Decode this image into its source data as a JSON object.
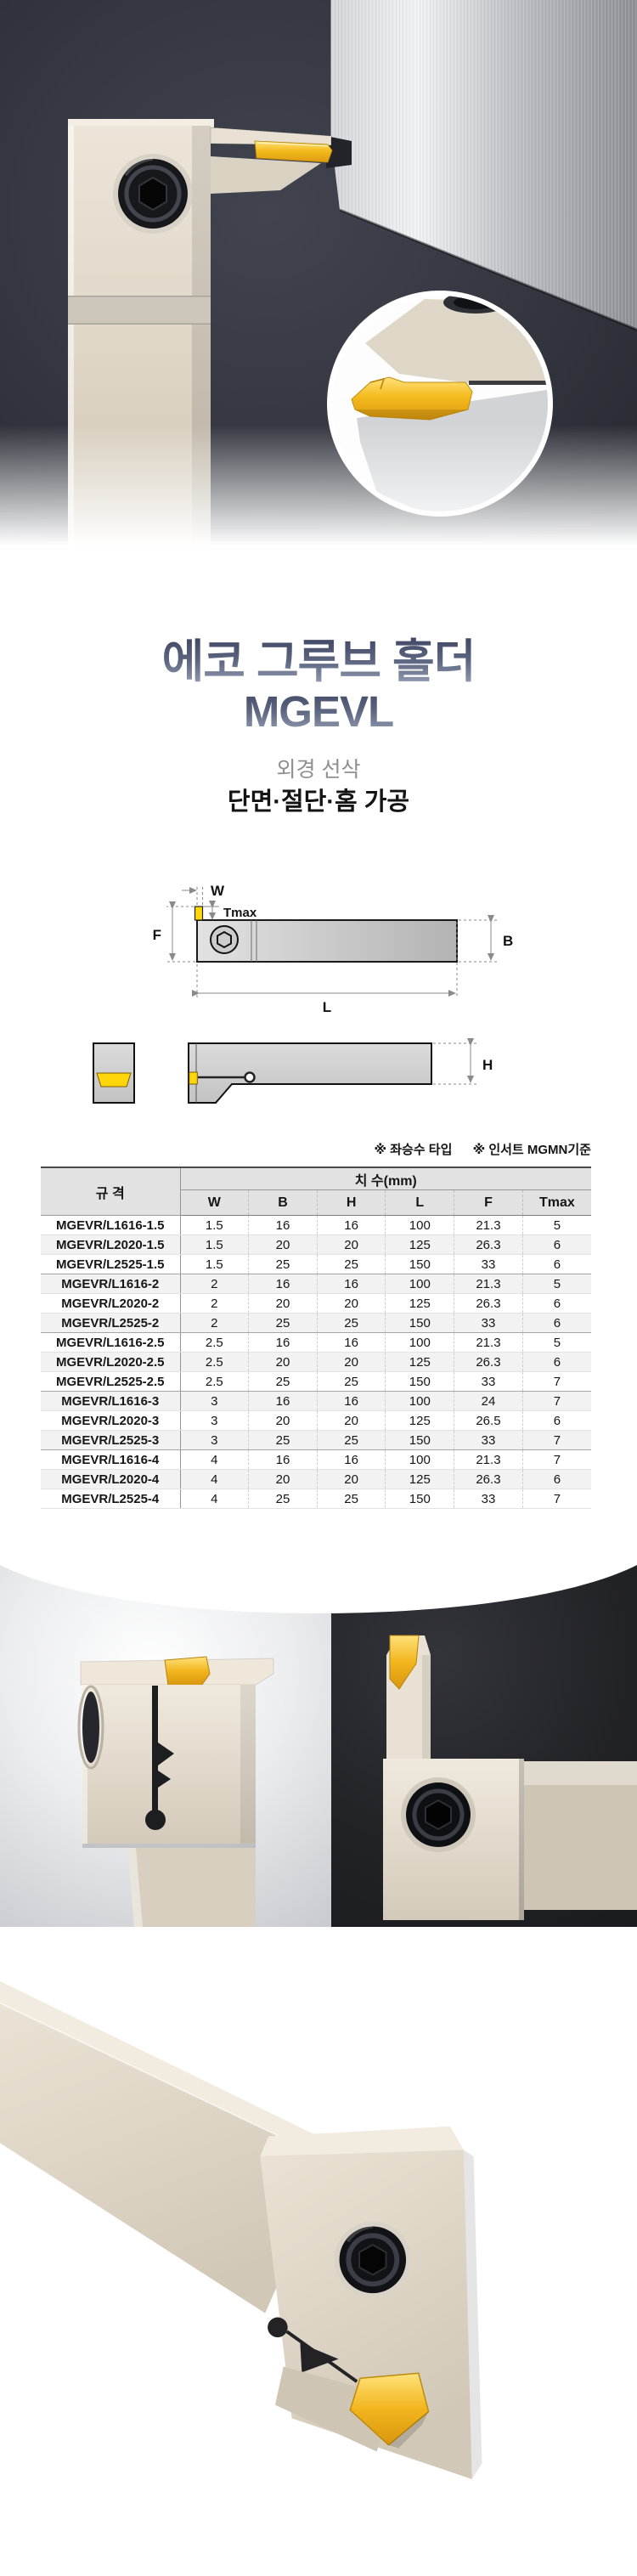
{
  "header": {
    "title_line1": "에코 그루브 홀더",
    "title_line2": "MGEVL",
    "subtitle": "외경 선삭",
    "machining": "단면·절단·홈 가공"
  },
  "notes": {
    "hand_type": "※ 좌승수 타입",
    "insert_standard": "※ 인서트 MGMN기준"
  },
  "diagram": {
    "labels": {
      "w": "W",
      "tmax": "Tmax",
      "f": "F",
      "b": "B",
      "l": "L",
      "h": "H"
    }
  },
  "table": {
    "spec_header": "규 격",
    "dim_header": "치 수(mm)",
    "columns": [
      "W",
      "B",
      "H",
      "L",
      "F",
      "Tmax"
    ],
    "rows": [
      {
        "spec": "MGEVR/L1616-1.5",
        "values": [
          "1.5",
          "16",
          "16",
          "100",
          "21.3",
          "5"
        ]
      },
      {
        "spec": "MGEVR/L2020-1.5",
        "values": [
          "1.5",
          "20",
          "20",
          "125",
          "26.3",
          "6"
        ]
      },
      {
        "spec": "MGEVR/L2525-1.5",
        "values": [
          "1.5",
          "25",
          "25",
          "150",
          "33",
          "6"
        ]
      },
      {
        "spec": "MGEVR/L1616-2",
        "values": [
          "2",
          "16",
          "16",
          "100",
          "21.3",
          "5"
        ]
      },
      {
        "spec": "MGEVR/L2020-2",
        "values": [
          "2",
          "20",
          "20",
          "125",
          "26.3",
          "6"
        ]
      },
      {
        "spec": "MGEVR/L2525-2",
        "values": [
          "2",
          "25",
          "25",
          "150",
          "33",
          "6"
        ]
      },
      {
        "spec": "MGEVR/L1616-2.5",
        "values": [
          "2.5",
          "16",
          "16",
          "100",
          "21.3",
          "5"
        ]
      },
      {
        "spec": "MGEVR/L2020-2.5",
        "values": [
          "2.5",
          "20",
          "20",
          "125",
          "26.3",
          "6"
        ]
      },
      {
        "spec": "MGEVR/L2525-2.5",
        "values": [
          "2.5",
          "25",
          "25",
          "150",
          "33",
          "7"
        ]
      },
      {
        "spec": "MGEVR/L1616-3",
        "values": [
          "3",
          "16",
          "16",
          "100",
          "24",
          "7"
        ]
      },
      {
        "spec": "MGEVR/L2020-3",
        "values": [
          "3",
          "20",
          "20",
          "125",
          "26.5",
          "6"
        ]
      },
      {
        "spec": "MGEVR/L2525-3",
        "values": [
          "3",
          "25",
          "25",
          "150",
          "33",
          "7"
        ]
      },
      {
        "spec": "MGEVR/L1616-4",
        "values": [
          "4",
          "16",
          "16",
          "100",
          "21.3",
          "7"
        ]
      },
      {
        "spec": "MGEVR/L2020-4",
        "values": [
          "4",
          "20",
          "20",
          "125",
          "26.3",
          "6"
        ]
      },
      {
        "spec": "MGEVR/L2525-4",
        "values": [
          "4",
          "25",
          "25",
          "150",
          "33",
          "7"
        ]
      }
    ]
  },
  "colors": {
    "gold_insert": "#f5bb1f",
    "champagne_metal": "#d5cbbc",
    "steel_workpiece": "#c2c3c8",
    "hero_background": "#32343d",
    "title_gradient_top": "#3e4563",
    "title_gradient_bottom": "#9ba4b9",
    "table_header_bg": "#e2e2e2",
    "table_alt_row_bg": "#f2f2f2"
  }
}
